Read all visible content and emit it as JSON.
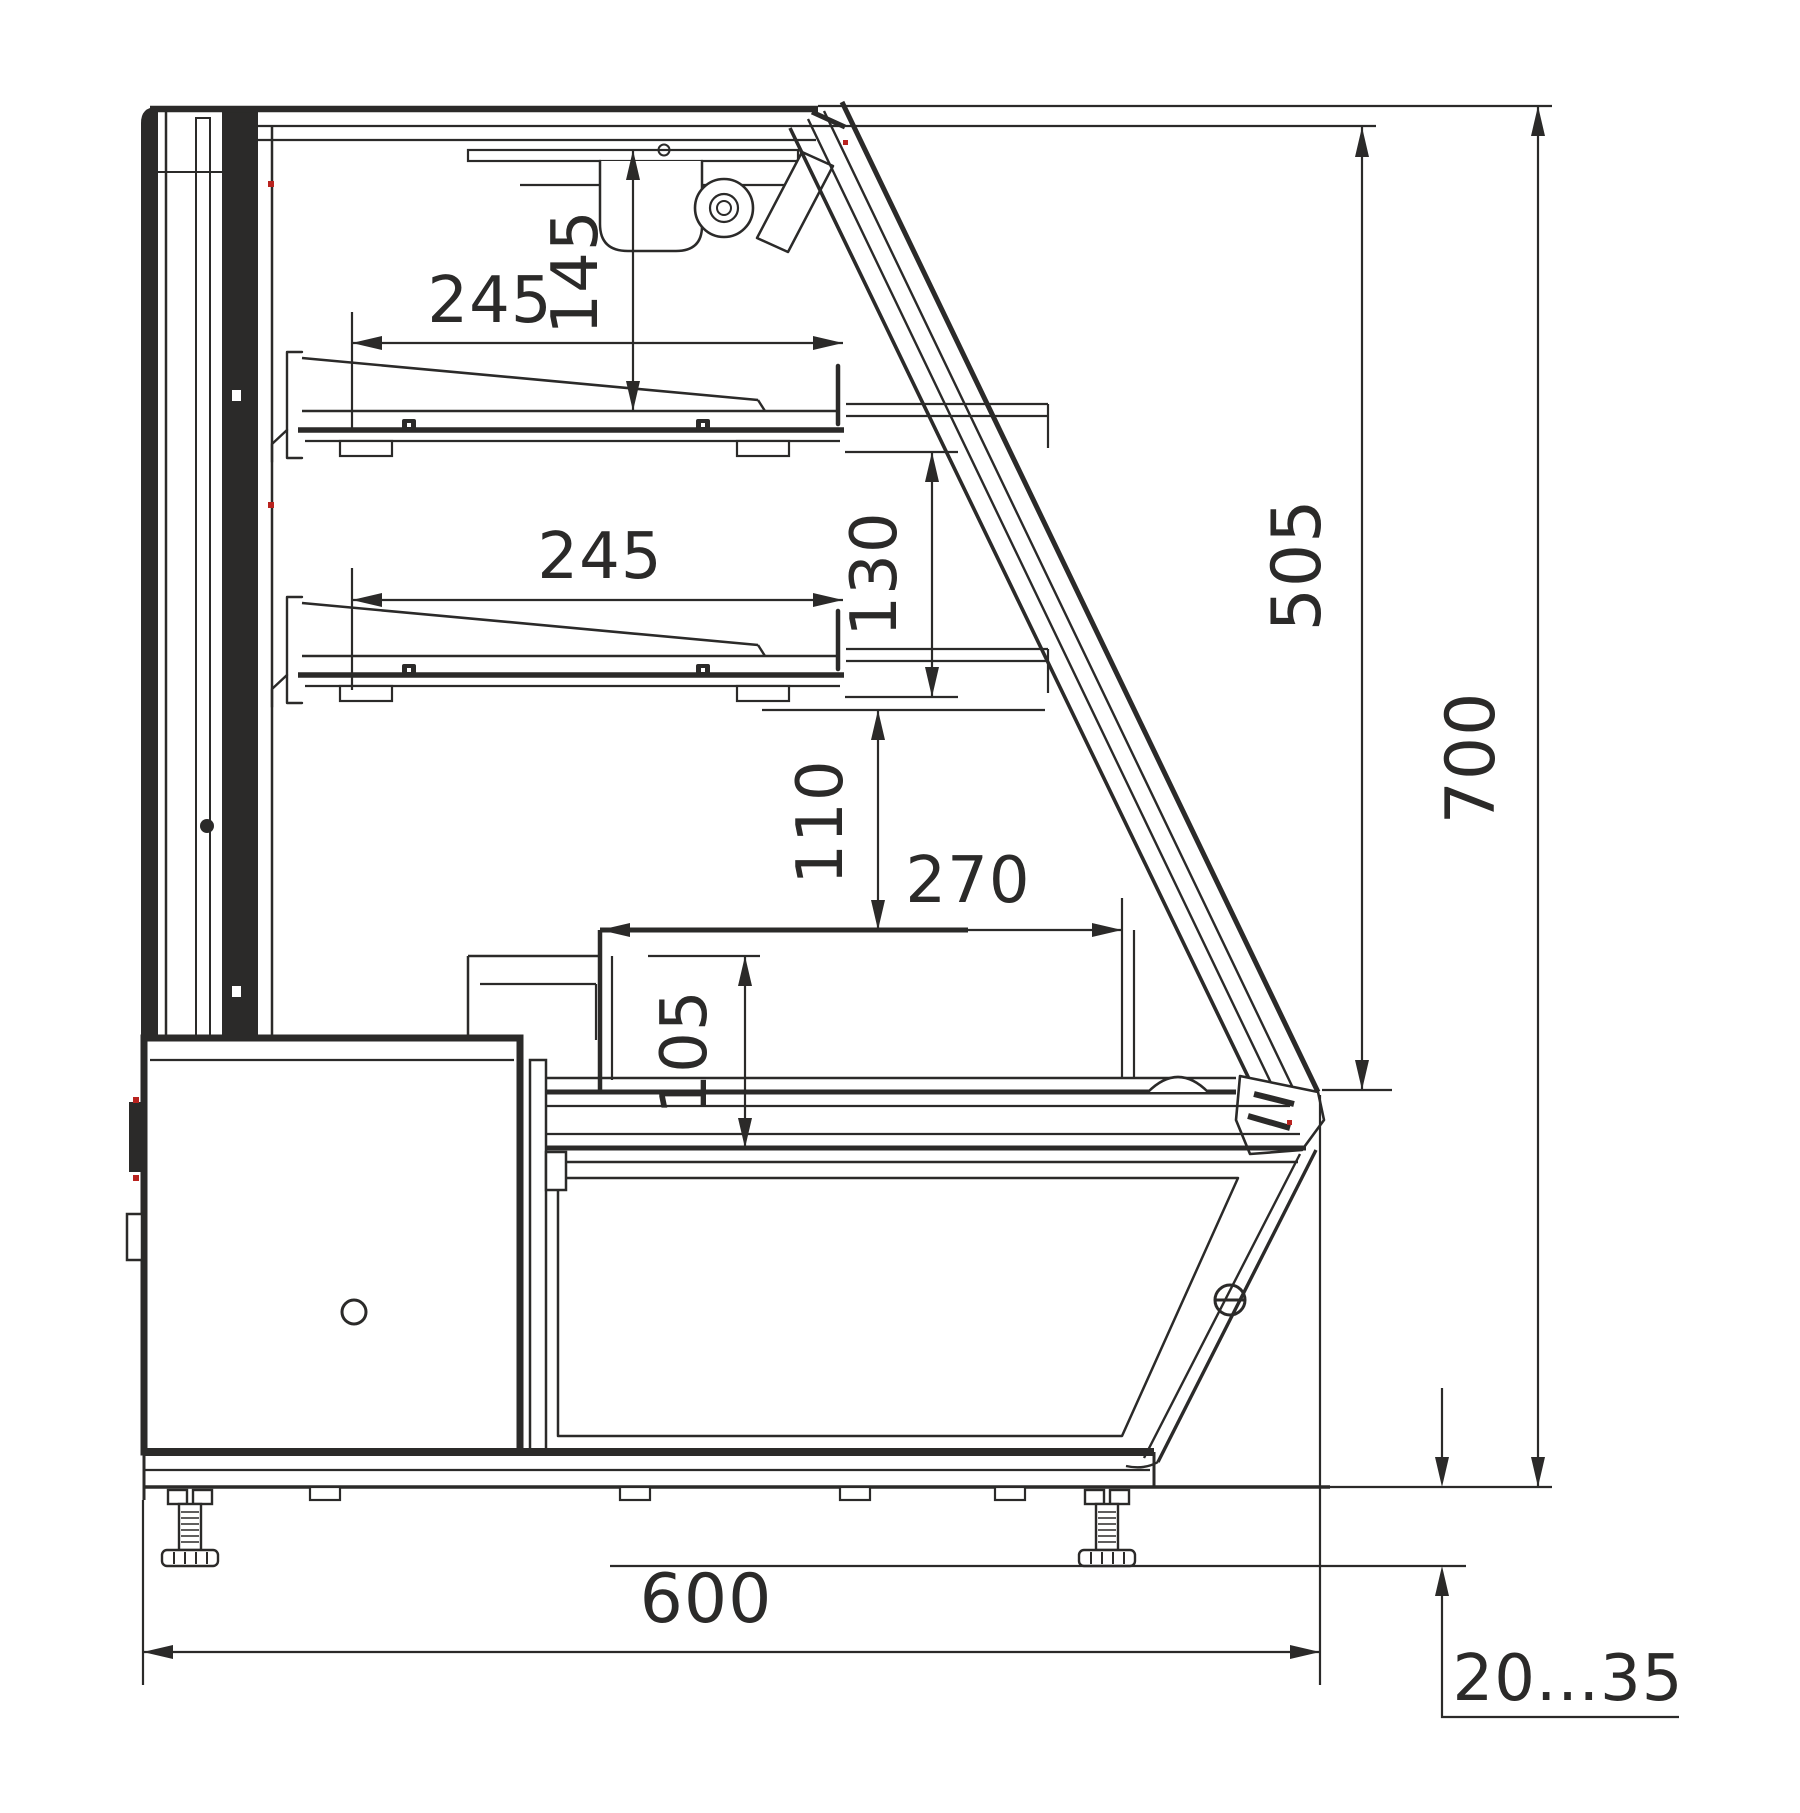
{
  "drawing": {
    "ink_color": "#2b2a29",
    "accent_color": "#b9231f",
    "background_color": "#ffffff",
    "dimensions": [
      {
        "id": "shelf-upper-depth",
        "label": "245",
        "orientation": "horizontal"
      },
      {
        "id": "canopy-to-shelf-1",
        "label": "145",
        "orientation": "vertical"
      },
      {
        "id": "shelf-lower-depth",
        "label": "245",
        "orientation": "horizontal"
      },
      {
        "id": "shelf-1-to-shelf-2",
        "label": "130",
        "orientation": "vertical"
      },
      {
        "id": "glass-opening-height",
        "label": "505",
        "orientation": "vertical"
      },
      {
        "id": "overall-height",
        "label": "700",
        "orientation": "vertical"
      },
      {
        "id": "shelf-2-to-deck",
        "label": "110",
        "orientation": "vertical"
      },
      {
        "id": "deck-depth",
        "label": "270",
        "orientation": "horizontal"
      },
      {
        "id": "well-depth-height",
        "label": "105",
        "orientation": "vertical"
      },
      {
        "id": "overall-depth",
        "label": "600",
        "orientation": "horizontal"
      },
      {
        "id": "foot-adjust-range",
        "label": "20...35",
        "orientation": "horizontal"
      }
    ]
  }
}
